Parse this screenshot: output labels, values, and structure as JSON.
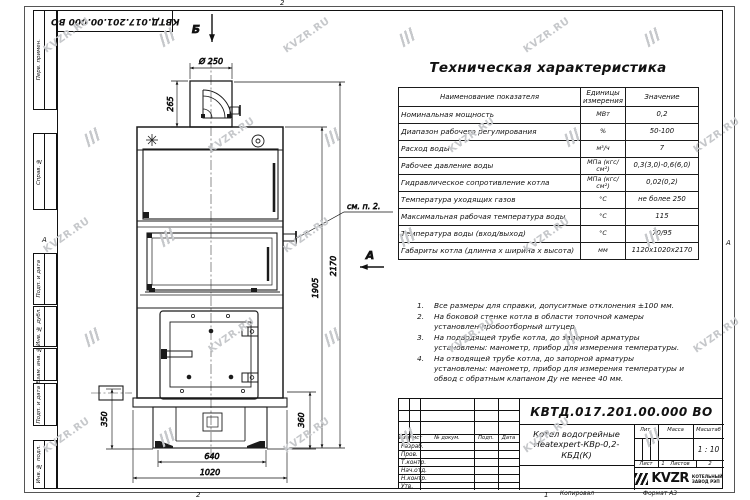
{
  "frame": {
    "margin_labels": [
      "Перв. примен.",
      "Справ. №",
      "Подп. и дата",
      "Инв. № дубл.",
      "Взам. инв. №",
      "Подп. и дата",
      "Инв. № подл."
    ],
    "top_stamp": "КВТД.017.201.00.000 ВО",
    "zone_left": "А",
    "zone_right": "А",
    "zone_top": "2",
    "zone_bottom_left": "2",
    "zone_bottom_center": "1"
  },
  "drawing": {
    "section_label": "Б",
    "view_label": "А",
    "callout": "см. п. 2.",
    "dim_diameter": "Ø 250",
    "dim_chimney_height": "265",
    "dim_total_height": "2170",
    "dim_body_height": "1905",
    "dim_left_height": "350",
    "dim_right_height": "360",
    "dim_base_width": "640",
    "dim_total_width": "1020"
  },
  "spec_table": {
    "title": "Техническая характеристика",
    "headers": [
      "Наименование показателя",
      "Единицы измерения",
      "Значение"
    ],
    "rows": [
      [
        "Номинальная мощность",
        "МВт",
        "0,2"
      ],
      [
        "Диапазон рабочего регулирования",
        "%",
        "50-100"
      ],
      [
        "Расход воды",
        "м³/ч",
        "7"
      ],
      [
        "Рабочее давление воды",
        "МПа (кгс/см²)",
        "0,3(3,0)-0,6(6,0)"
      ],
      [
        "Гидравлическое сопротивление котла",
        "МПа (кгс/см²)",
        "0,02(0,2)"
      ],
      [
        "Температура уходящих газов",
        "°С",
        "не более 250"
      ],
      [
        "Максимальная рабочая температура воды",
        "°С",
        "115"
      ],
      [
        "Температура воды (вход/выход)",
        "°С",
        "70/95"
      ],
      [
        "Габариты котла (длинна х ширина х высота)",
        "мм",
        "1120х1020х2170"
      ]
    ]
  },
  "notes": [
    {
      "n": "1.",
      "text": "Все размеры для справки, допуситмые отклонения ±100 мм."
    },
    {
      "n": "2.",
      "text": "На боковой стенке котла в области топочной камеры установлен пробоотборный штуцер."
    },
    {
      "n": "3.",
      "text": "На подводящей трубе котла, до запорной арматуры установлены: манометр, прибор для измерения температуры."
    },
    {
      "n": "4.",
      "text": "На отводящей трубе котла, до запорной арматуры установлены: манометр, прибор для измерения температуры и обвод с обратным клапаном Ду не менее 40 мм."
    }
  ],
  "title_block": {
    "doc_number": "КВТД.017.201.00.000 ВО",
    "name_line1": "Котел водогрейные",
    "name_line2": "Heatexpert-КВр-0,2- КБД(К)",
    "columns": [
      "Изм",
      "Лист",
      "№ докум.",
      "Подп.",
      "Дата"
    ],
    "roles": [
      "Разраб.",
      "Пров.",
      "Т.контр.",
      "Нач.отд.",
      "Н.контр.",
      "Утв."
    ],
    "lit_label": "Лит.",
    "mass_label": "Масса",
    "scale_label": "Масштаб",
    "scale_value": "1 : 10",
    "sheet_label": "Лист",
    "sheet_value": "1",
    "sheets_label": "Листов",
    "sheets_value": "2",
    "logo_text": "KVZR",
    "company_line1": "КОТЕЛЬНЫЙ",
    "company_line2": "ЗАВОД РЭП",
    "copy_label": "Копировал",
    "format_label": "Формат А3"
  },
  "watermark": {
    "text": "KVZR.RU",
    "color": "#c6c8cb"
  }
}
